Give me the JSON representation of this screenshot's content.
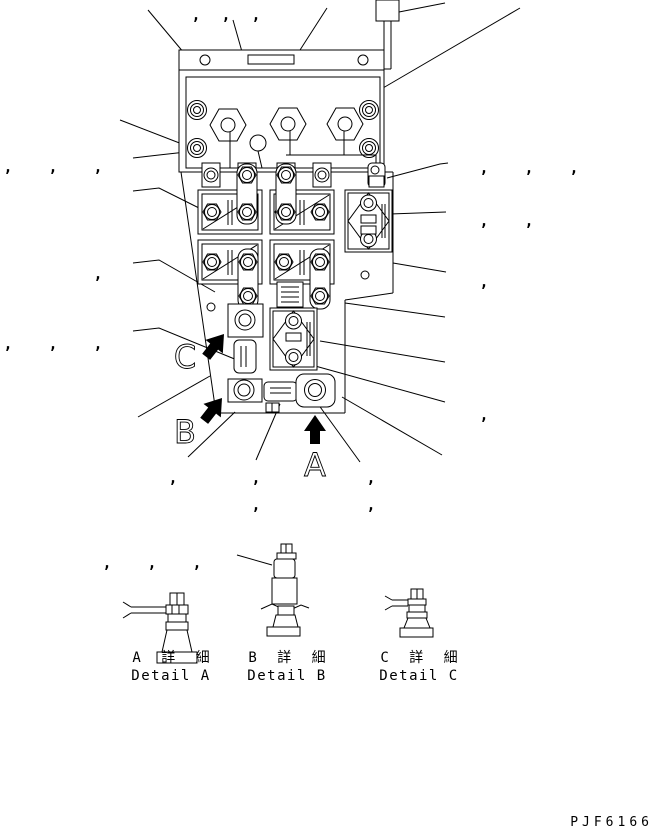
{
  "page": {
    "background": "#ffffff",
    "ink": "#000000",
    "code": "PJF6166"
  },
  "callout_glyph": ",",
  "callouts": [
    [
      196,
      20
    ],
    [
      226,
      20
    ],
    [
      256,
      20
    ],
    [
      8,
      172
    ],
    [
      53,
      172
    ],
    [
      98,
      172
    ],
    [
      98,
      279
    ],
    [
      8,
      349
    ],
    [
      53,
      349
    ],
    [
      98,
      349
    ],
    [
      484,
      173
    ],
    [
      529,
      173
    ],
    [
      574,
      173
    ],
    [
      484,
      226
    ],
    [
      529,
      226
    ],
    [
      484,
      287
    ],
    [
      484,
      420
    ],
    [
      173,
      483
    ],
    [
      256,
      483
    ],
    [
      371,
      483
    ],
    [
      256,
      510
    ],
    [
      371,
      510
    ],
    [
      107,
      568
    ],
    [
      152,
      568
    ],
    [
      197,
      568
    ]
  ],
  "leader_lines": [
    [
      [
        148,
        10
      ],
      [
        205,
        78
      ]
    ],
    [
      [
        233,
        20
      ],
      [
        250,
        80
      ]
    ],
    [
      [
        327,
        8
      ],
      [
        300,
        50
      ],
      [
        291,
        112
      ]
    ],
    [
      [
        399,
        12
      ],
      [
        445,
        3
      ]
    ],
    [
      [
        383,
        88
      ],
      [
        520,
        8
      ]
    ],
    [
      [
        120,
        120
      ],
      [
        195,
        149
      ]
    ],
    [
      [
        133,
        158
      ],
      [
        159,
        155
      ],
      [
        195,
        151
      ]
    ],
    [
      [
        133,
        191
      ],
      [
        159,
        188
      ],
      [
        207,
        212
      ]
    ],
    [
      [
        133,
        263
      ],
      [
        159,
        260
      ],
      [
        215,
        292
      ]
    ],
    [
      [
        133,
        331
      ],
      [
        159,
        328
      ],
      [
        237,
        360
      ]
    ],
    [
      [
        210,
        376
      ],
      [
        138,
        417
      ]
    ],
    [
      [
        235,
        412
      ],
      [
        188,
        457
      ]
    ],
    [
      [
        280,
        404
      ],
      [
        256,
        460
      ]
    ],
    [
      [
        318,
        404
      ],
      [
        360,
        462
      ]
    ],
    [
      [
        342,
        397
      ],
      [
        442,
        455
      ]
    ],
    [
      [
        345,
        303
      ],
      [
        445,
        317
      ]
    ],
    [
      [
        320,
        341
      ],
      [
        445,
        362
      ]
    ],
    [
      [
        308,
        364
      ],
      [
        445,
        402
      ]
    ],
    [
      [
        387,
        178
      ],
      [
        440,
        164
      ],
      [
        448,
        163
      ]
    ],
    [
      [
        390,
        214
      ],
      [
        446,
        212
      ]
    ],
    [
      [
        393,
        263
      ],
      [
        446,
        272
      ]
    ],
    [
      [
        237,
        555
      ],
      [
        272,
        565
      ]
    ]
  ],
  "pointer_letters": [
    {
      "label": "C",
      "x": 185,
      "y": 368
    },
    {
      "label": "B",
      "x": 185,
      "y": 443
    },
    {
      "label": "A",
      "x": 315,
      "y": 476
    }
  ],
  "details": [
    {
      "id": "A",
      "caption_jp": "A 詳 細",
      "caption_en": "Detail A"
    },
    {
      "id": "B",
      "caption_jp": "B 詳 細",
      "caption_en": "Detail B"
    },
    {
      "id": "C",
      "caption_jp": "C 詳 細",
      "caption_en": "Detail C"
    }
  ]
}
